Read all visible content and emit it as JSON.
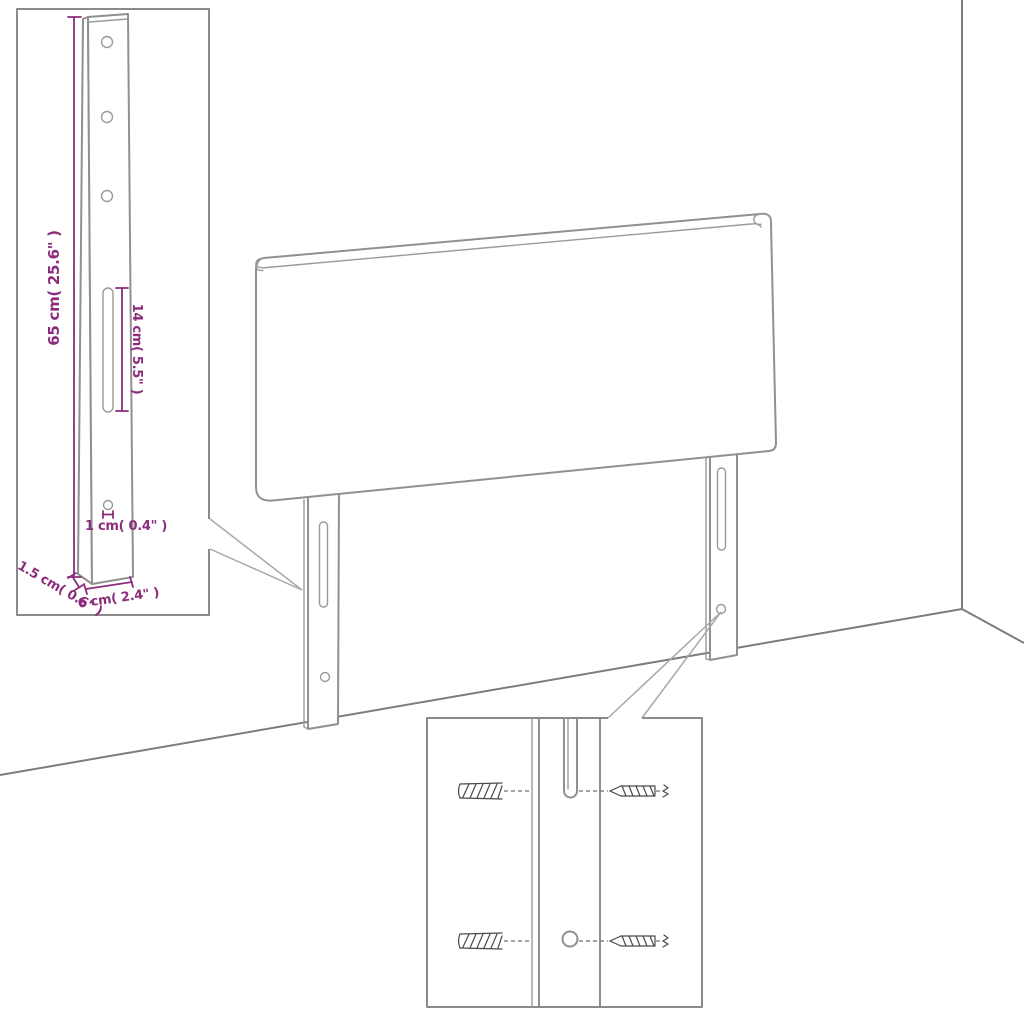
{
  "scene": {
    "type": "furniture-assembly-diagram",
    "subject": "upholstered headboard with two wall-mount legs",
    "background": "#ffffff"
  },
  "colors": {
    "furniture_outline": "#909090",
    "room_lines": "#7d7d7d",
    "callout_lines": "#a8a8a8",
    "dimension_annotations": "#8b2d7c",
    "hardware_detail": "#4a4a4a"
  },
  "dimensions": {
    "bracket_height": "65 cm( 25.6\" )",
    "slot_length": "14 cm( 5.5\" )",
    "hole_diameter": "1 cm( 0.4\" )",
    "bracket_thickness": "1.5 cm( 0.6\" )",
    "bracket_width": "6 cm( 2.4\" )"
  }
}
